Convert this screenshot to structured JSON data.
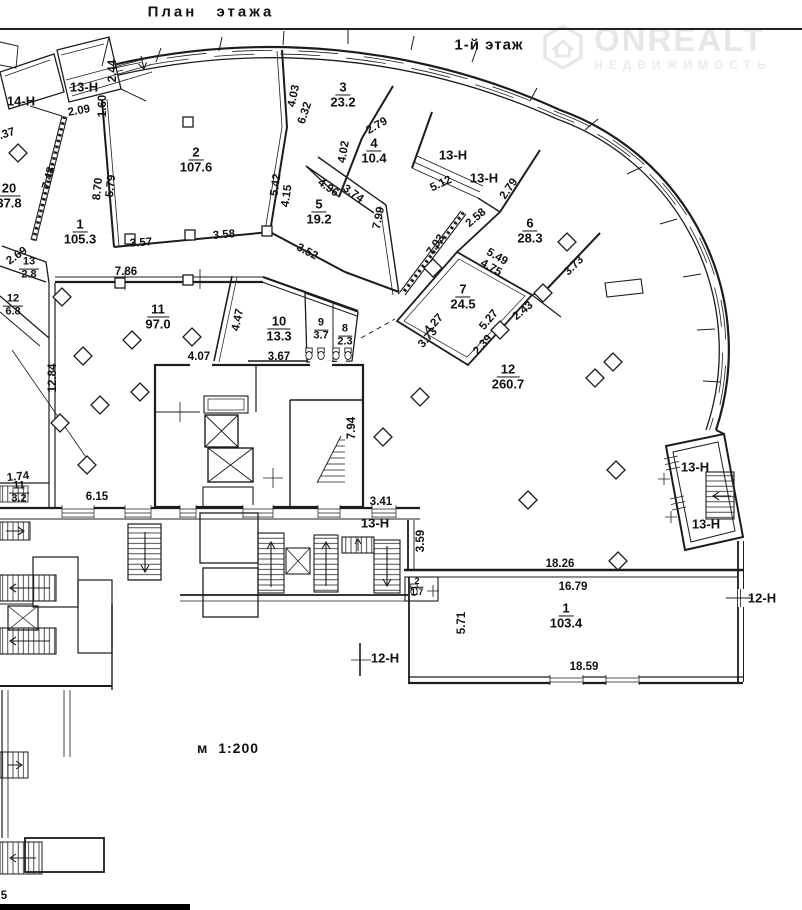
{
  "page": {
    "title": "План этажа",
    "floor_label": "1-й этаж",
    "scale_label": "м 1:200"
  },
  "watermark": {
    "brand": "ONREALT",
    "subtitle": "НЕДВИЖИМОСТЬ",
    "color": "#e9e7e3"
  },
  "colors": {
    "wall": "#1c1c1c",
    "label_text": "#111111",
    "background": "#ffffff"
  },
  "plan": {
    "rooms": [
      {
        "num": "1",
        "area": "105.3",
        "x": 80,
        "y": 232
      },
      {
        "num": "2",
        "area": "107.6",
        "x": 196,
        "y": 160
      },
      {
        "num": "3",
        "area": "23.2",
        "x": 343,
        "y": 95
      },
      {
        "num": "4",
        "area": "10.4",
        "x": 374,
        "y": 151
      },
      {
        "num": "5",
        "area": "19.2",
        "x": 319,
        "y": 212
      },
      {
        "num": "6",
        "area": "28.3",
        "x": 530,
        "y": 231
      },
      {
        "num": "7",
        "area": "24.5",
        "x": 463,
        "y": 297
      },
      {
        "num": "8",
        "area": "2.3",
        "x": 345,
        "y": 336,
        "s": 1
      },
      {
        "num": "9",
        "area": "3.7",
        "x": 321,
        "y": 330,
        "s": 1
      },
      {
        "num": "10",
        "area": "13.3",
        "x": 279,
        "y": 329
      },
      {
        "num": "11",
        "area": "97.0",
        "x": 158,
        "y": 317
      },
      {
        "num": "12",
        "area": "260.7",
        "x": 508,
        "y": 377
      },
      {
        "num": "13",
        "area": "2.8",
        "x": 29,
        "y": 269,
        "s": 1
      },
      {
        "num": "12",
        "area": "6.8",
        "x": 13,
        "y": 306,
        "s": 1
      },
      {
        "num": "20",
        "area": "37.8",
        "x": 9,
        "y": 196
      },
      {
        "num": "11",
        "area": "3.2",
        "x": 19,
        "y": 493,
        "s": 1
      },
      {
        "num": "1",
        "area": "103.4",
        "x": 566,
        "y": 616
      },
      {
        "num": "2",
        "area": "1.7",
        "x": 417,
        "y": 587,
        "s": 2
      }
    ],
    "dims": [
      {
        "t": "2.09",
        "x": 79,
        "y": 111,
        "r": -10
      },
      {
        "t": "1.60",
        "x": 103,
        "y": 106,
        "r": -90
      },
      {
        "t": "2.44",
        "x": 113,
        "y": 71,
        "r": -90
      },
      {
        "t": "1.37",
        "x": 4,
        "y": 135,
        "r": -18
      },
      {
        "t": "7.48",
        "x": 49,
        "y": 178,
        "r": -75
      },
      {
        "t": "8.70",
        "x": 98,
        "y": 189,
        "r": -84
      },
      {
        "t": "5.79",
        "x": 111,
        "y": 186,
        "r": -84
      },
      {
        "t": "2.69",
        "x": 17,
        "y": 256,
        "r": -35
      },
      {
        "t": "3.57",
        "x": 141,
        "y": 243,
        "r": -4
      },
      {
        "t": "3.58",
        "x": 224,
        "y": 235,
        "r": -5
      },
      {
        "t": "3.52",
        "x": 307,
        "y": 252,
        "r": 28
      },
      {
        "t": "7.86",
        "x": 126,
        "y": 272,
        "r": 0
      },
      {
        "t": "4.03",
        "x": 294,
        "y": 96,
        "r": -78
      },
      {
        "t": "6.32",
        "x": 305,
        "y": 113,
        "r": -72
      },
      {
        "t": "2.79",
        "x": 377,
        "y": 126,
        "r": -30
      },
      {
        "t": "4.02",
        "x": 344,
        "y": 152,
        "r": -80
      },
      {
        "t": "4.96",
        "x": 328,
        "y": 188,
        "r": 35
      },
      {
        "t": "3.74",
        "x": 353,
        "y": 194,
        "r": 35
      },
      {
        "t": "5.42",
        "x": 276,
        "y": 185,
        "r": -82
      },
      {
        "t": "4.15",
        "x": 287,
        "y": 196,
        "r": -82
      },
      {
        "t": "7.99",
        "x": 379,
        "y": 218,
        "r": -78
      },
      {
        "t": "5.12",
        "x": 441,
        "y": 184,
        "r": -25
      },
      {
        "t": "2.79",
        "x": 509,
        "y": 189,
        "r": -55
      },
      {
        "t": "2.58",
        "x": 476,
        "y": 218,
        "r": -40
      },
      {
        "t": "7.93",
        "x": 436,
        "y": 245,
        "r": -55
      },
      {
        "t": "5.49",
        "x": 497,
        "y": 257,
        "r": 30
      },
      {
        "t": "4.75",
        "x": 491,
        "y": 268,
        "r": 30
      },
      {
        "t": "3.73",
        "x": 574,
        "y": 266,
        "r": -45
      },
      {
        "t": "5.27",
        "x": 489,
        "y": 320,
        "r": -50
      },
      {
        "t": "2.43",
        "x": 523,
        "y": 311,
        "r": -40
      },
      {
        "t": "4.27",
        "x": 434,
        "y": 324,
        "r": -48
      },
      {
        "t": "3.73",
        "x": 428,
        "y": 338,
        "r": -48
      },
      {
        "t": "2.39",
        "x": 483,
        "y": 345,
        "r": -48
      },
      {
        "t": "4.47",
        "x": 238,
        "y": 320,
        "r": -78
      },
      {
        "t": "4.07",
        "x": 199,
        "y": 357,
        "r": 0
      },
      {
        "t": "3.67",
        "x": 279,
        "y": 357,
        "r": 0
      },
      {
        "t": "12.84",
        "x": 53,
        "y": 378,
        "r": -90
      },
      {
        "t": "1.74",
        "x": 18,
        "y": 477,
        "r": -6
      },
      {
        "t": "6.15",
        "x": 97,
        "y": 497,
        "r": 0
      },
      {
        "t": "7.94",
        "x": 352,
        "y": 428,
        "r": -90
      },
      {
        "t": "3.41",
        "x": 381,
        "y": 502,
        "r": 0
      },
      {
        "t": "3.59",
        "x": 421,
        "y": 541,
        "r": -90
      },
      {
        "t": "18.26",
        "x": 560,
        "y": 564,
        "r": 0
      },
      {
        "t": "16.79",
        "x": 573,
        "y": 587,
        "r": 0
      },
      {
        "t": "5.71",
        "x": 462,
        "y": 623,
        "r": -90
      },
      {
        "t": "18.59",
        "x": 584,
        "y": 667,
        "r": 0
      },
      {
        "t": "5",
        "x": 4,
        "y": 896,
        "r": 0
      }
    ],
    "units": [
      {
        "t": "14-Н",
        "x": 21,
        "y": 101
      },
      {
        "t": "13-Н",
        "x": 84,
        "y": 87
      },
      {
        "t": "13-Н",
        "x": 453,
        "y": 155
      },
      {
        "t": "13-Н",
        "x": 484,
        "y": 178
      },
      {
        "t": "13-Н",
        "x": 375,
        "y": 523
      },
      {
        "t": "13-Н",
        "x": 695,
        "y": 467
      },
      {
        "t": "13-Н",
        "x": 706,
        "y": 524
      },
      {
        "t": "12-Н",
        "x": 762,
        "y": 598
      },
      {
        "t": "12-Н",
        "x": 385,
        "y": 658
      }
    ]
  }
}
